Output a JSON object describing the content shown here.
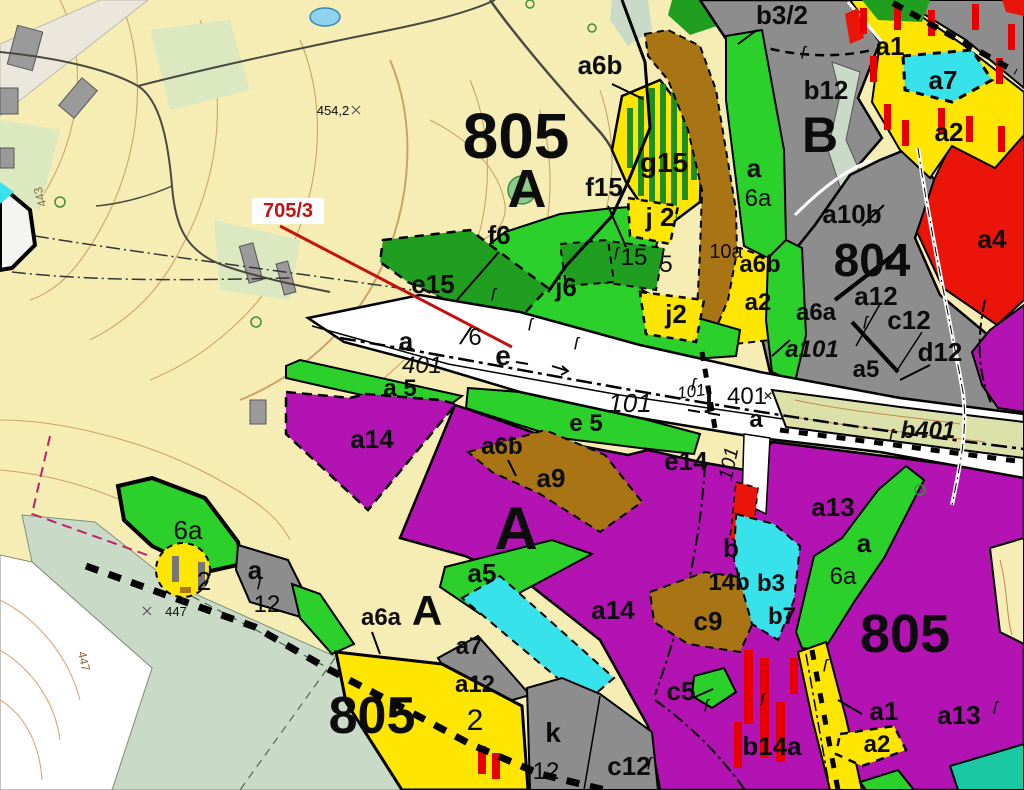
{
  "colors": {
    "cream": "#F6EDB5",
    "contour": "#C49659",
    "sage": "#C9DAC6",
    "white": "#FFFFFF",
    "green": "#2BD02B",
    "darkGreen": "#1F9E1F",
    "yellow": "#FFE600",
    "purple": "#B313B3",
    "brown": "#A87414",
    "gray": "#8D8D8D",
    "building": "#9A9A9A",
    "cyan": "#38E2EA",
    "red": "#EA1408",
    "olive": "#DCE1AA",
    "teal": "#1BC8A4",
    "stripeGreen": "#1E8E1E",
    "barRed": "#E60000",
    "barGray": "#777777",
    "roadDark": "#4A4A42",
    "pond": "#8FD2EC",
    "yard": "#DCE8C0",
    "urban": "#EBE7DC",
    "magenta": "#C2206A",
    "calloutRed": "#C21212"
  },
  "symbols": {
    "sect": "ſ",
    "cross": "✕"
  },
  "labels": {
    "u805t": {
      "t": "805"
    },
    "uAt": {
      "t": "A"
    },
    "u804": {
      "t": "804"
    },
    "uB": {
      "t": "B"
    },
    "u805bl": {
      "t": "805"
    },
    "u805br": {
      "t": "805"
    },
    "uAmid": {
      "t": "A"
    },
    "uAbl": {
      "t": "A"
    },
    "a6b_top": {
      "t": "a6b"
    },
    "b32": {
      "t": "b3/2"
    },
    "b12": {
      "t": "b12"
    },
    "a1tr": {
      "t": "a1"
    },
    "a7tr": {
      "t": "a7"
    },
    "a2tr": {
      "t": "a2"
    },
    "a4": {
      "t": "a4"
    },
    "a10b": {
      "t": "a10b"
    },
    "a12r": {
      "t": "a12"
    },
    "c12r": {
      "t": "c12"
    },
    "d12": {
      "t": "d12"
    },
    "a6ar": {
      "t": "a6a"
    },
    "a101": {
      "t": "a101"
    },
    "a5r": {
      "t": "a5"
    },
    "aband": {
      "t": "a"
    },
    "n6aband": {
      "t": "6a"
    },
    "n10a": {
      "t": "10a"
    },
    "a6bmid": {
      "t": "a6b"
    },
    "a2mid": {
      "t": "a2"
    },
    "g15": {
      "t": "g15"
    },
    "f15": {
      "t": "f15"
    },
    "f6": {
      "t": "f6"
    },
    "e15": {
      "t": "e15"
    },
    "j2a": {
      "t": "j 2"
    },
    "n15": {
      "t": "15"
    },
    "n5": {
      "t": "5"
    },
    "j6": {
      "t": "j6"
    },
    "j2b": {
      "t": "j2"
    },
    "n6": {
      "t": "6"
    },
    "ew": {
      "t": "e"
    },
    "a401a": {
      "t": "a"
    },
    "a401n": {
      "t": "401"
    },
    "a5w": {
      "t": "a 5"
    },
    "r101a": {
      "t": "101"
    },
    "r101b": {
      "t": "101"
    },
    "jjct": {
      "t": "j"
    },
    "n401": {
      "t": "401"
    },
    "ajct": {
      "t": "a"
    },
    "e5": {
      "t": "e 5"
    },
    "a14w": {
      "t": "a14"
    },
    "a6bc": {
      "t": "a6b"
    },
    "a9": {
      "t": "a9"
    },
    "e14": {
      "t": "e14"
    },
    "v101": {
      "t": "101"
    },
    "b401": {
      "t": "b401"
    },
    "a13c": {
      "t": "a13"
    },
    "ag7": {
      "t": "a"
    },
    "n6ag7": {
      "t": "6a"
    },
    "bl": {
      "t": "b"
    },
    "n14b": {
      "t": "14b"
    },
    "b3": {
      "t": "b3"
    },
    "b7": {
      "t": "b7"
    },
    "c9": {
      "t": "c9"
    },
    "c5": {
      "t": "c5"
    },
    "b14a": {
      "t": "b14a"
    },
    "a1br": {
      "t": "a1"
    },
    "a2br": {
      "t": "a2"
    },
    "a13br": {
      "t": "a13"
    },
    "c12b": {
      "t": "c12"
    },
    "k": {
      "t": "k"
    },
    "n12k": {
      "t": "12"
    },
    "a12b": {
      "t": "a12"
    },
    "a7b": {
      "t": "a7"
    },
    "a6ab": {
      "t": "a6a"
    },
    "a14c": {
      "t": "a14"
    },
    "a5c": {
      "t": "a5"
    },
    "n2y": {
      "t": "2"
    },
    "n6abl": {
      "t": "6a"
    },
    "n2bl": {
      "t": "2"
    },
    "abl": {
      "t": "a"
    },
    "n12bl": {
      "t": "12"
    },
    "spot447": {
      "t": "447"
    },
    "spot454": {
      "t": "454,2"
    },
    "rot443": {
      "t": "443"
    },
    "rot447w": {
      "t": "447"
    },
    "callout705": {
      "t": "705/3"
    }
  }
}
